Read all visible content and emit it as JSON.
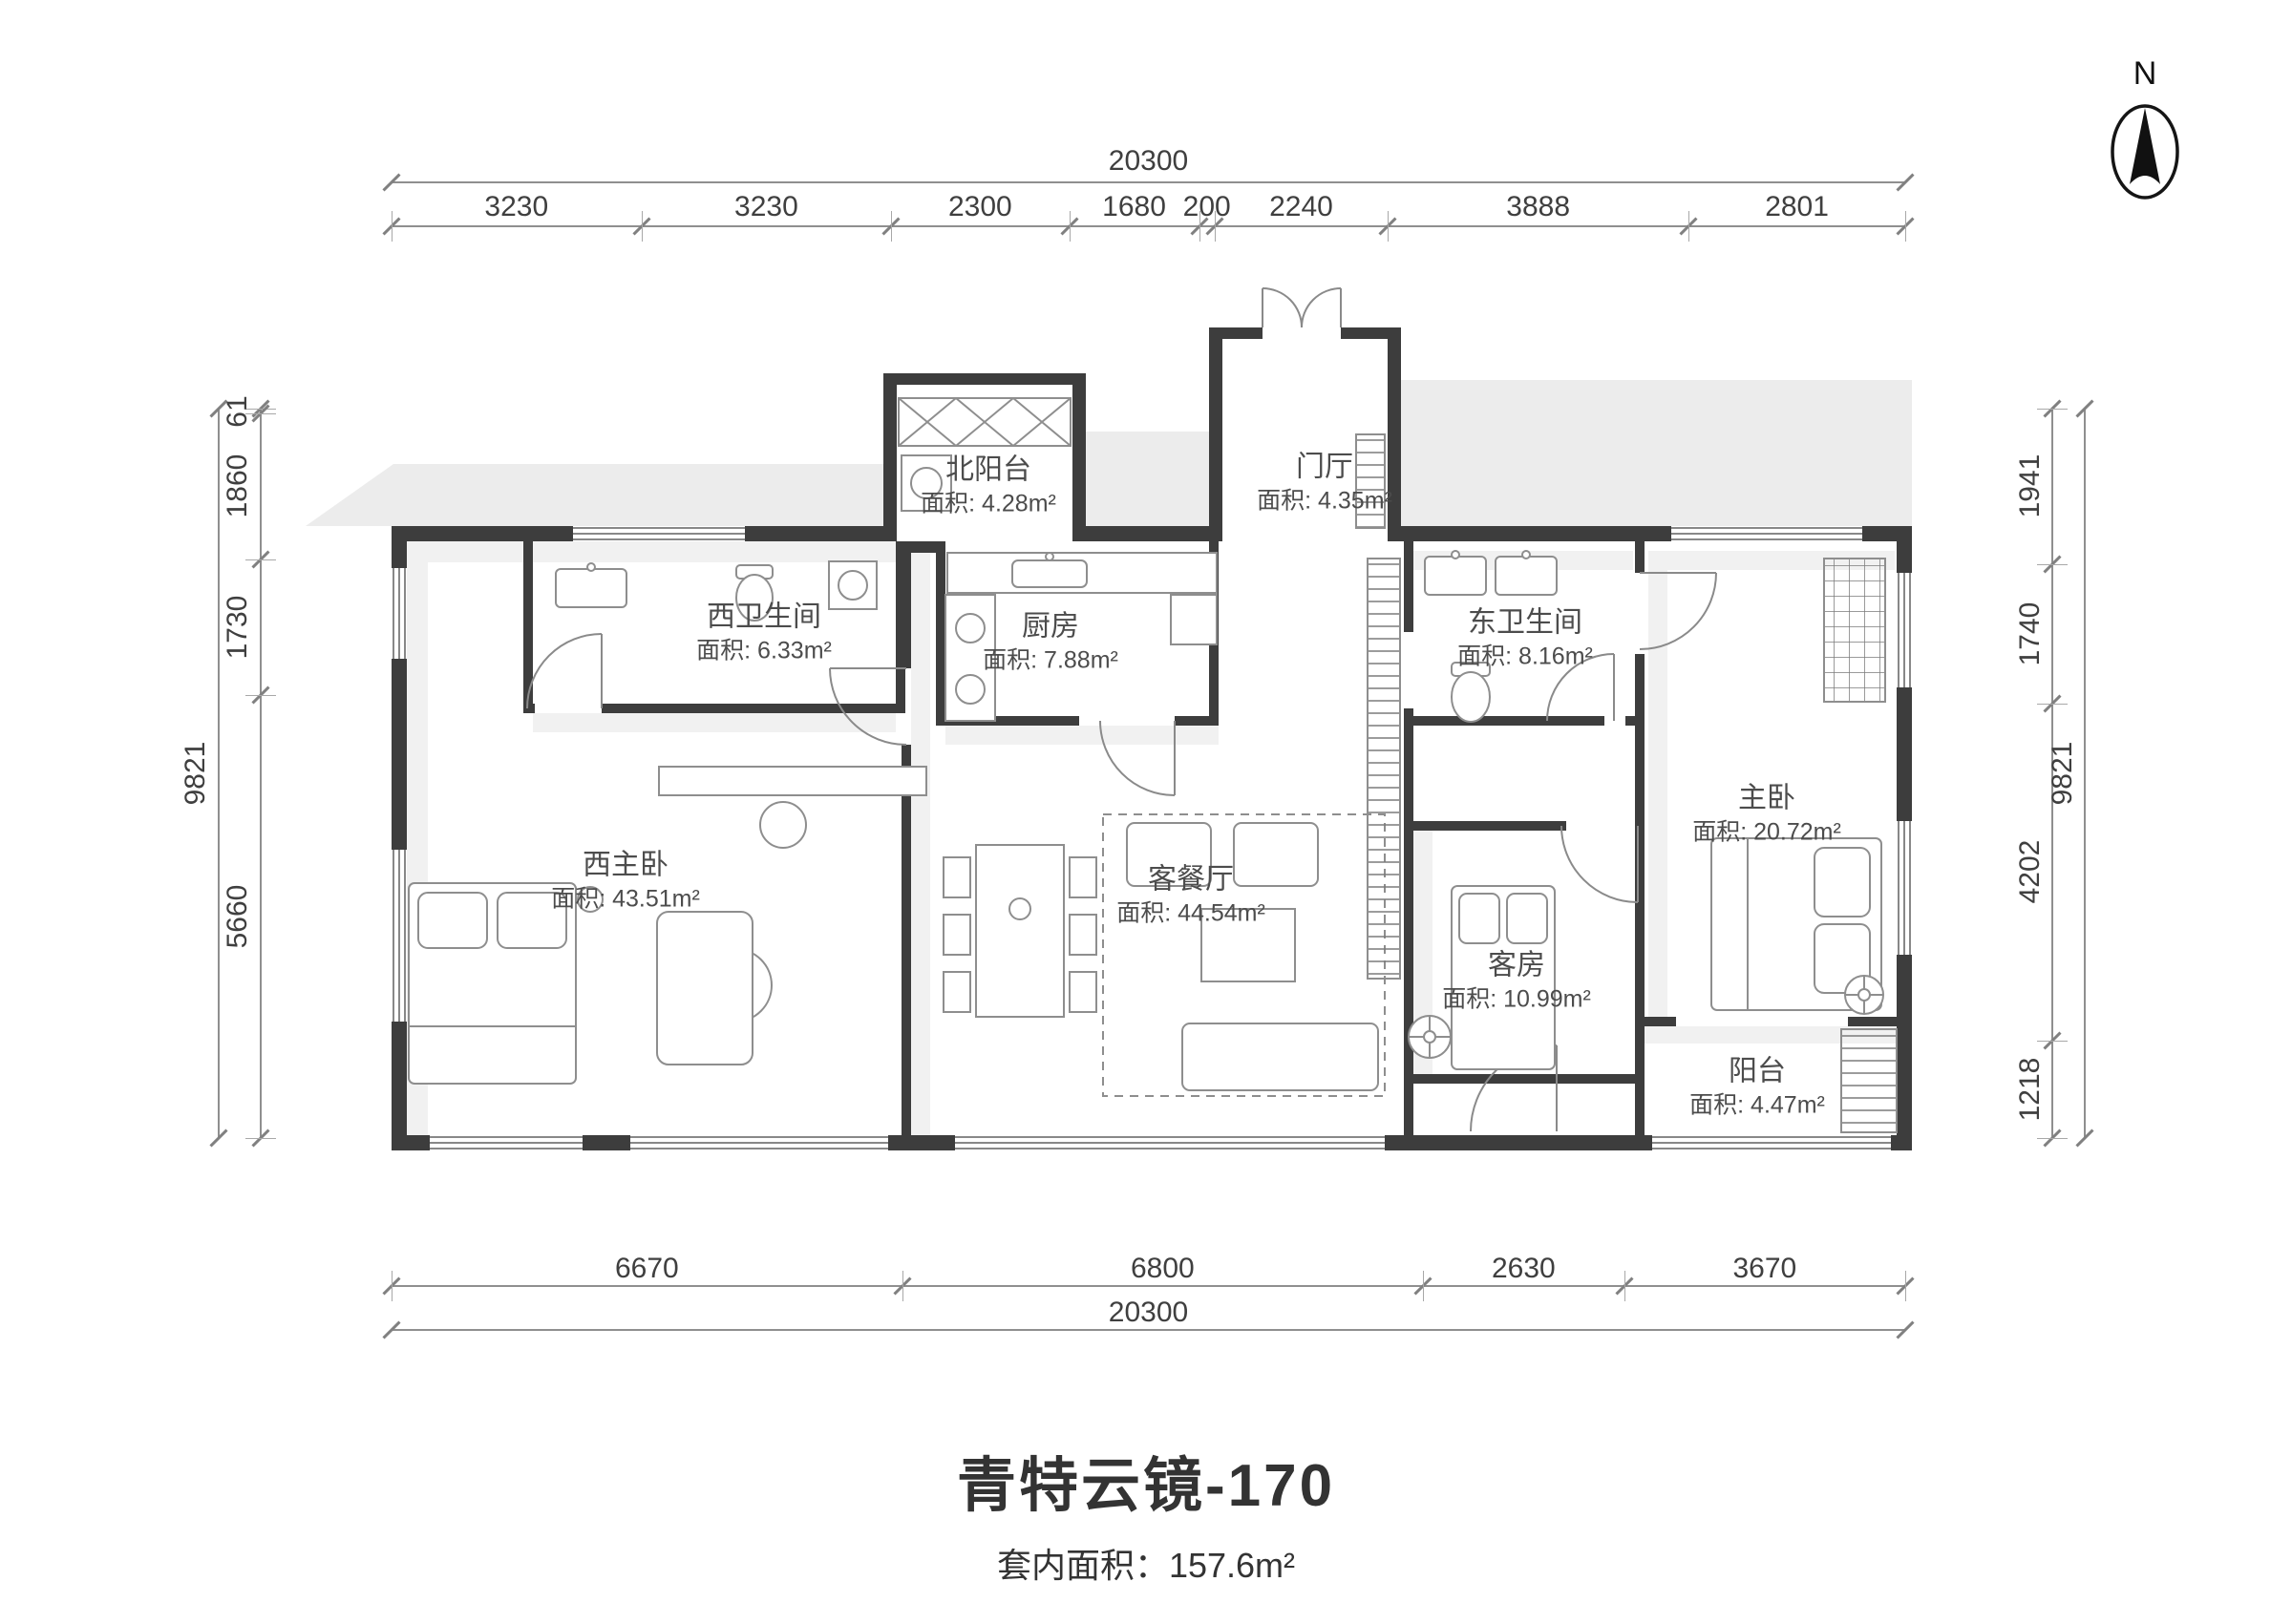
{
  "north": {
    "label": "N"
  },
  "title": {
    "name": "青特云镜-170",
    "area": "套内面积：157.6m²"
  },
  "rooms": [
    {
      "id": "north-balcony",
      "name": "北阳台",
      "area": "面积: 4.28m²"
    },
    {
      "id": "foyer",
      "name": "门厅",
      "area": "面积: 4.35m²"
    },
    {
      "id": "west-bathroom",
      "name": "西卫生间",
      "area": "面积: 6.33m²"
    },
    {
      "id": "kitchen",
      "name": "厨房",
      "area": "面积: 7.88m²"
    },
    {
      "id": "east-bathroom",
      "name": "东卫生间",
      "area": "面积: 8.16m²"
    },
    {
      "id": "west-master-bedroom",
      "name": "西主卧",
      "area": "面积: 43.51m²"
    },
    {
      "id": "living-dining-room",
      "name": "客餐厅",
      "area": "面积: 44.54m²"
    },
    {
      "id": "master-bedroom",
      "name": "主卧",
      "area": "面积: 20.72m²"
    },
    {
      "id": "guest-room",
      "name": "客房",
      "area": "面积: 10.99m²"
    },
    {
      "id": "south-balcony",
      "name": "阳台",
      "area": "面积: 4.47m²"
    }
  ],
  "dimensions": {
    "top": {
      "total": "20300",
      "segments": [
        "3230",
        "3230",
        "2300",
        "1680",
        "200",
        "2240",
        "3888",
        "2801"
      ]
    },
    "bottom": {
      "total": "20300",
      "segments": [
        "6670",
        "6800",
        "2630",
        "3670"
      ]
    },
    "left": {
      "total": "9821",
      "segments": [
        "61",
        "1860",
        "1730",
        "5660"
      ]
    },
    "right": {
      "total": "9821",
      "segments": [
        "1941",
        "1740",
        "4202",
        "1218"
      ]
    }
  },
  "colors": {
    "wall": "#3d3d3d",
    "dim_line": "#8f8f8f",
    "text": "#4c4c4c",
    "shadow": "#ececec"
  }
}
